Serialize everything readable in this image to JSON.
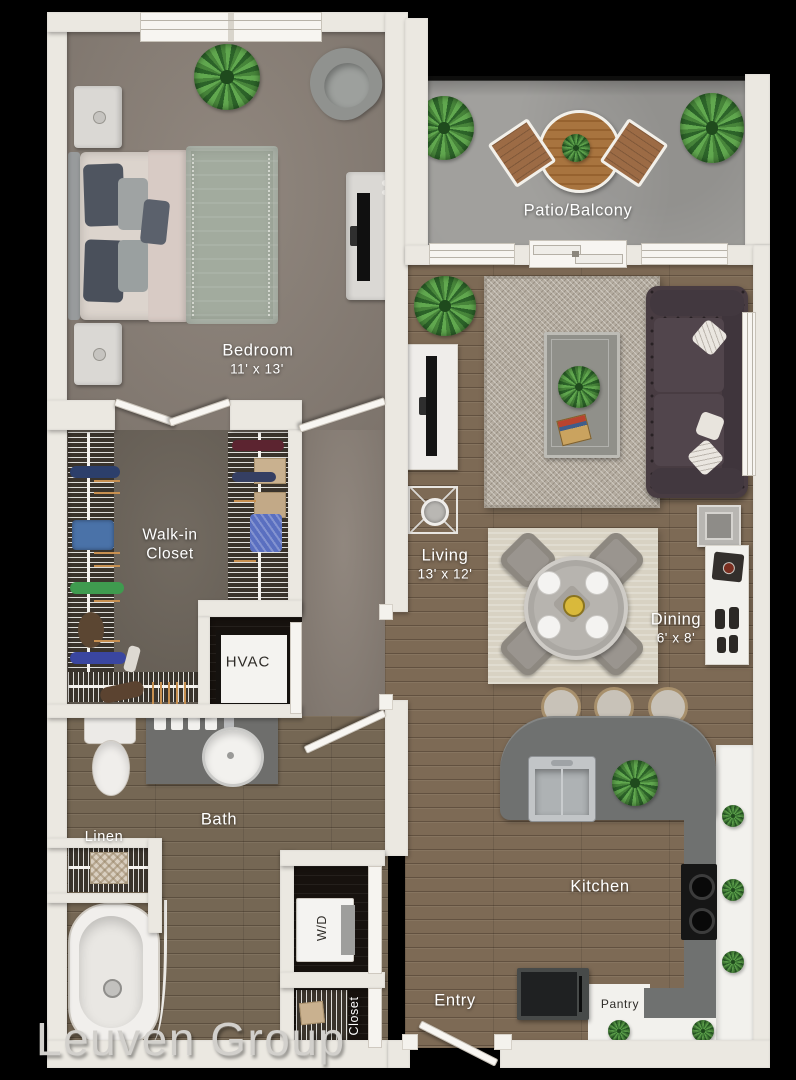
{
  "canvas": {
    "width": 796,
    "height": 1080
  },
  "watermark": {
    "text": "Leuven Group"
  },
  "palette": {
    "bg": "#000000",
    "wall": "#ebe8e1",
    "carpet": "#8b8178",
    "closetFloor": "#6d655b",
    "wood": "#7d6a55",
    "bathWood": "#756754",
    "concrete": "#9b9a97",
    "rugLiving": "#b4aca0",
    "rugDining": "#d8d2c3",
    "sofa": "#483c42",
    "counter": "#6f7170",
    "counterWhite": "#f2f1ed",
    "labelLight": "#ffffff",
    "labelDark": "#2e2b27",
    "watermark": "#d2d0cc"
  },
  "rooms": {
    "bedroom": {
      "label": "Bedroom",
      "dims": "11' x 13'"
    },
    "patio": {
      "label": "Patio/Balcony"
    },
    "living": {
      "label": "Living",
      "dims": "13' x 12'"
    },
    "dining": {
      "label": "Dining",
      "dims": "6' x 8'"
    },
    "walk_in_closet": {
      "label": "Walk-in Closet"
    },
    "hvac": {
      "label": "HVAC"
    },
    "bath": {
      "label": "Bath"
    },
    "linen": {
      "label": "Linen"
    },
    "kitchen": {
      "label": "Kitchen"
    },
    "washer_dryer": {
      "label": "W/D"
    },
    "entry": {
      "label": "Entry"
    },
    "entry_closet": {
      "label": "Closet"
    },
    "pantry": {
      "label": "Pantry"
    }
  }
}
